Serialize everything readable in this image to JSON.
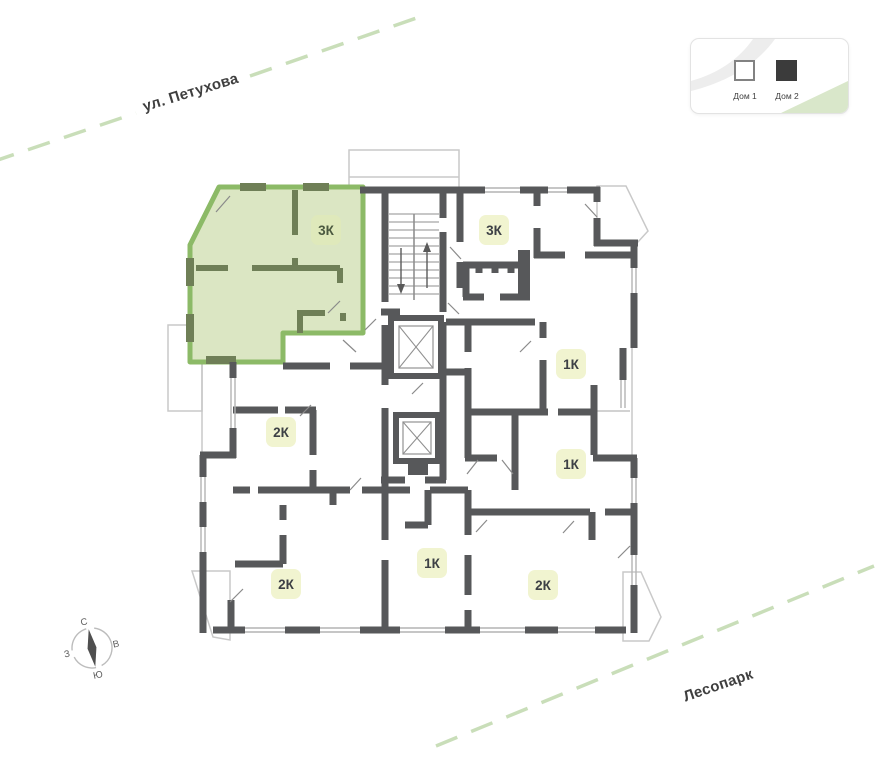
{
  "map_labels": {
    "street_top": "ул. Петухова",
    "park_bottom": "Лесопарк"
  },
  "legend": {
    "house1": "Дом 1",
    "house2": "Дом 2"
  },
  "compass": {
    "n": "С",
    "e": "В",
    "s": "Ю",
    "w": "З"
  },
  "floorplan": {
    "apartments": [
      {
        "label": "3К",
        "selected": true
      },
      {
        "label": "3К",
        "selected": false
      },
      {
        "label": "1К",
        "selected": false
      },
      {
        "label": "1К",
        "selected": false
      },
      {
        "label": "2К",
        "selected": false
      },
      {
        "label": "2К",
        "selected": false
      },
      {
        "label": "1К",
        "selected": false
      },
      {
        "label": "2К",
        "selected": false
      }
    ]
  },
  "colors": {
    "wall": "#57585a",
    "highlight_border": "#8cba67",
    "highlight_fill": "#dbe6c3",
    "highlight_wall": "#6f7f57",
    "badge_fill": "#f1f4d0",
    "badge_selected_fill": "#dfe9bb",
    "street_dash": "#c9deb9",
    "legend_green": "#d9e7ca"
  }
}
